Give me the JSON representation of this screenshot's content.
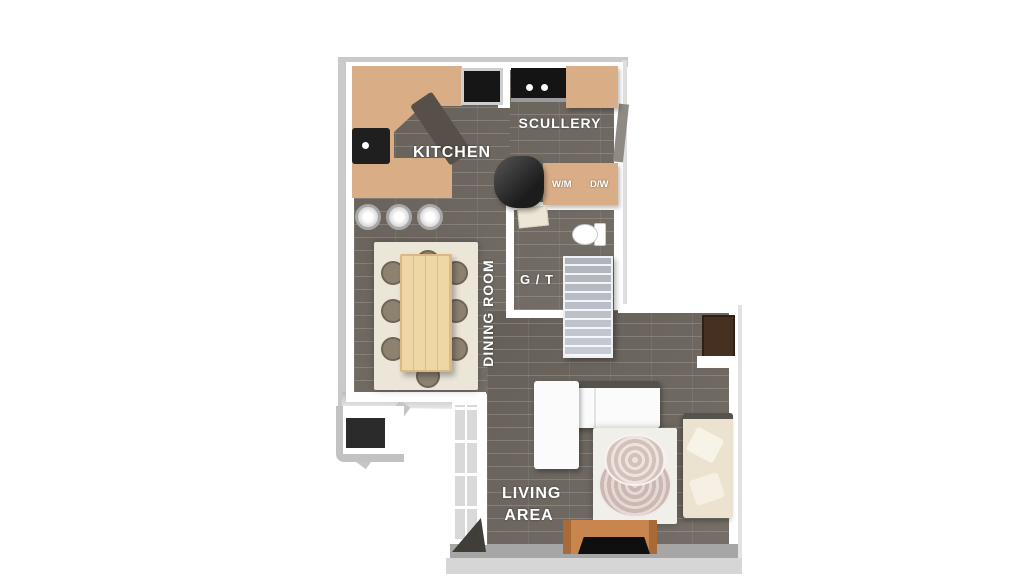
{
  "page": {
    "type": "3d-floor-plan-render",
    "background": "#ffffff"
  },
  "rooms": [
    {
      "id": "kitchen",
      "label": "KITCHEN"
    },
    {
      "id": "scullery",
      "label": "SCULLERY"
    },
    {
      "id": "guest_toilet",
      "label": "G / T"
    },
    {
      "id": "dining_room",
      "label": "DINING ROOM"
    },
    {
      "id": "living_area",
      "label_line1": "LIVING",
      "label_line2": "AREA"
    }
  ],
  "appliance_labels": {
    "washing_machine": "W/M",
    "dishwasher": "D/W"
  },
  "colors": {
    "floor": "#6e6760",
    "wall": "#ffffff",
    "exterior_edge": "#c9c9c9",
    "counter_tan": "#d9ae87",
    "appliance_black": "#161616",
    "stairs_gray": "#c7cbd4",
    "dining_rug": "#ece6d8",
    "dining_table_wood": "#eed7a4",
    "chair_taupe": "#8d8170",
    "sofa_white": "#fbfbfb",
    "sofa_cream": "#ebe3cf",
    "living_rug": "#f1efe9",
    "coffee_table_pink": "#d0bcb6",
    "tv_stand_wood": "#c8854d",
    "tv_black": "#0f0f0f",
    "corner_cabinet_brown": "#46301f",
    "label_text": "#ffffff"
  }
}
